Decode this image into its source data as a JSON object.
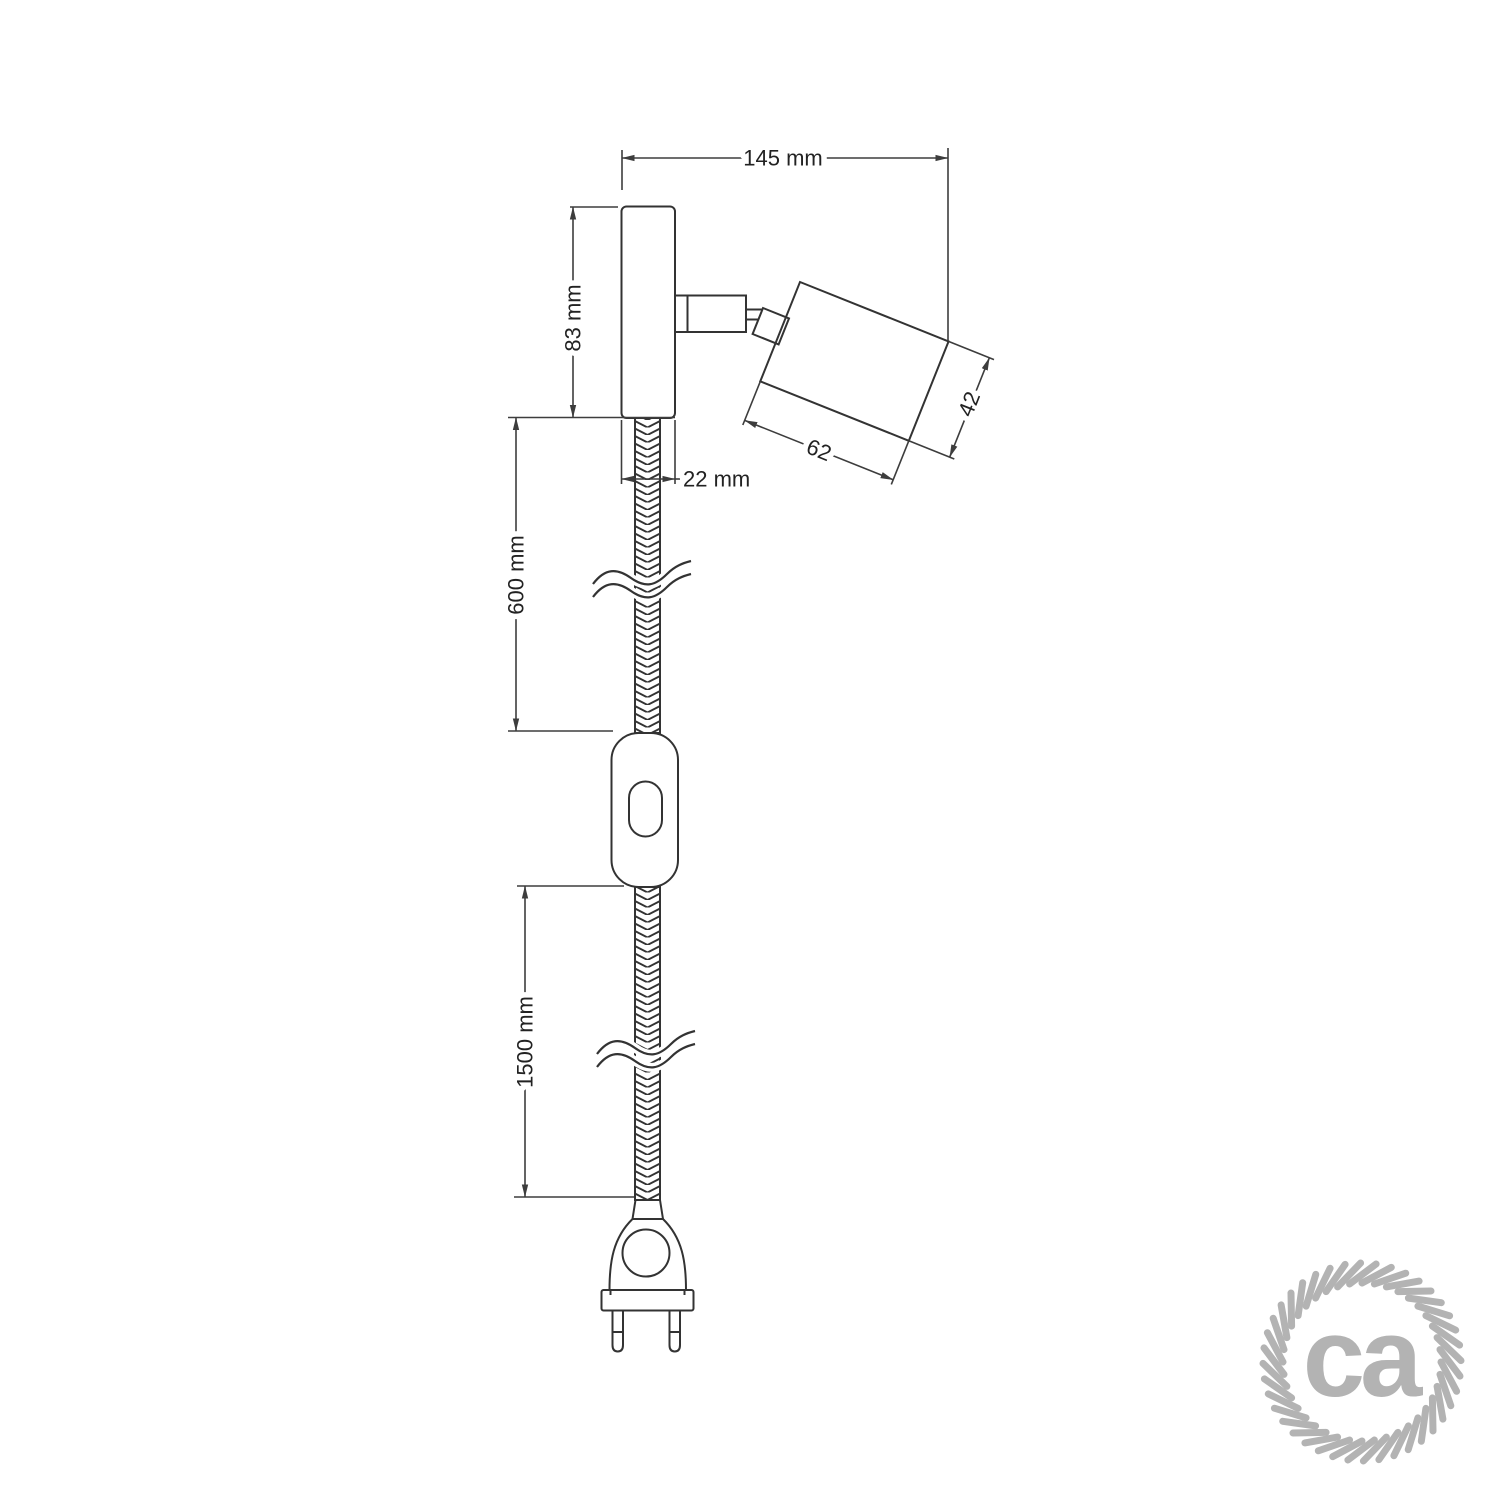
{
  "diagram": {
    "title_visible": false,
    "dimensions": {
      "total_width": "145 mm",
      "plate_height": "83 mm",
      "plate_depth": "22 mm",
      "spot_body_length": "62",
      "spot_body_diameter": "42",
      "upper_cable_length": "600 mm",
      "lower_cable_length": "1500 mm"
    }
  },
  "logo": {
    "text": "ca"
  },
  "colors": {
    "object_line": "#333333",
    "dimension_line": "#3d3d3d",
    "text": "#222222",
    "logo_gray": "#b3b3b3",
    "background": "#ffffff"
  }
}
